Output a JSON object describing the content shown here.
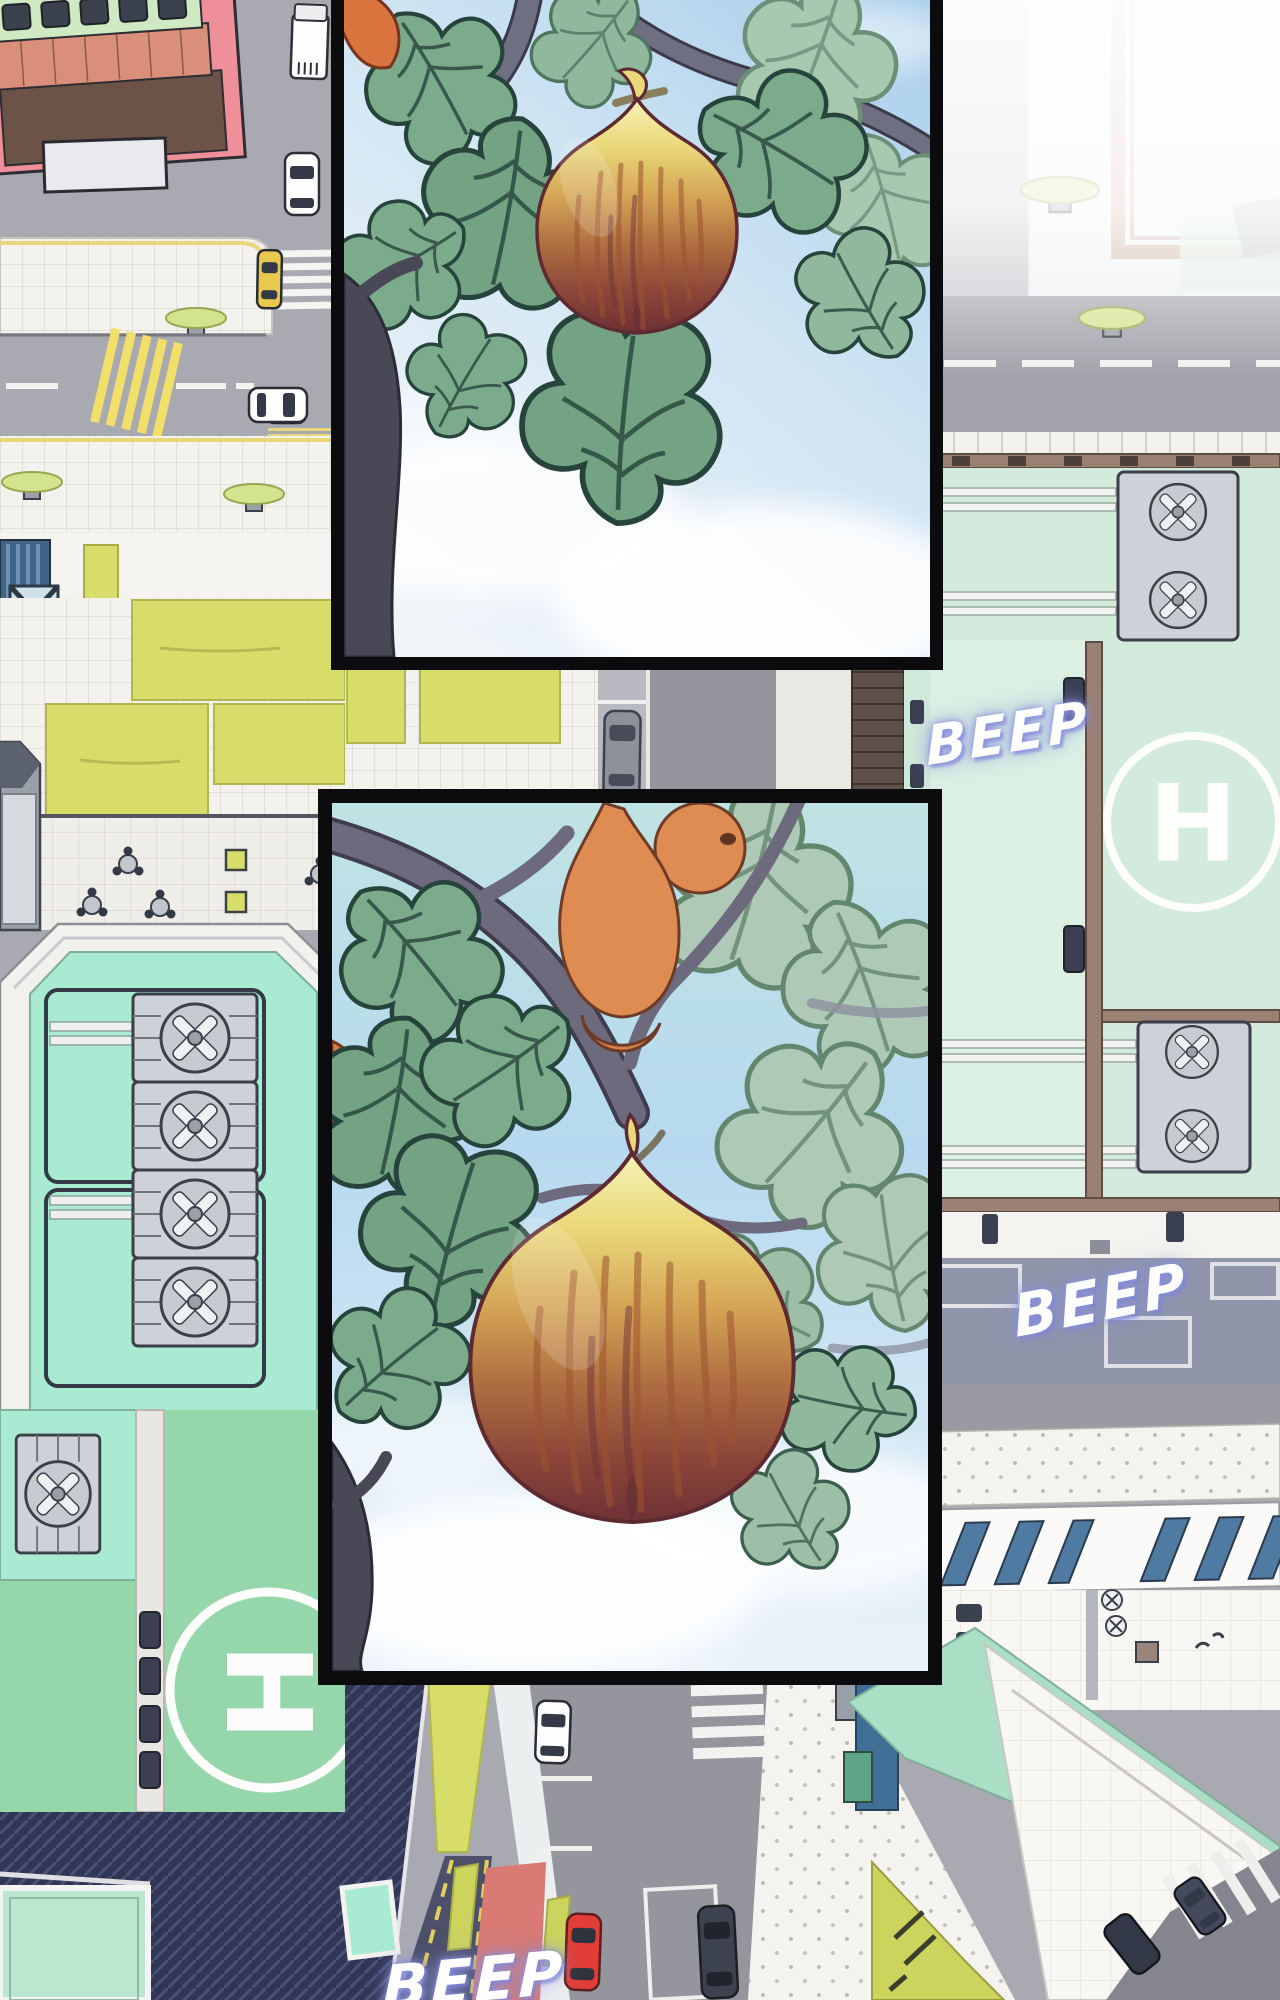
{
  "page": {
    "type": "webtoon-comic-scene",
    "setting": "aerial top-down view of a pastel city block with rooftops, helipads, streets and cars",
    "panels": [
      {
        "id": "panel-1",
        "subject": "close-up of a ripe fig hanging from a leafy branch against a blue sky"
      },
      {
        "id": "panel-2",
        "subject": "fig tree with orange fruits and a large ripe fig against a blue sky with clouds"
      }
    ],
    "sound_effects": [
      {
        "text": "BEEP",
        "location": "upper-right rooftop"
      },
      {
        "text": "BEEP",
        "location": "right parking deck"
      },
      {
        "text": "BEEP",
        "location": "bottom-center street"
      }
    ],
    "helipads": [
      {
        "label": "H",
        "location": "right rooftop"
      },
      {
        "label": "H",
        "location": "left rooftop"
      }
    ],
    "colors": {
      "panel_border": "#0c0c0f",
      "sky": "#b7d9ef",
      "fig_top": "#ead97a",
      "fig_bottom": "#6f3136",
      "leaf": "#7cab8c",
      "roof_mint": "#d2ebdc",
      "roof_green": "#95d6ab",
      "roof_teal": "#a9ebd2",
      "road": "#9a9aa2",
      "grass": "#d8dd6a",
      "sfx_glow": "#8c92dd"
    }
  }
}
